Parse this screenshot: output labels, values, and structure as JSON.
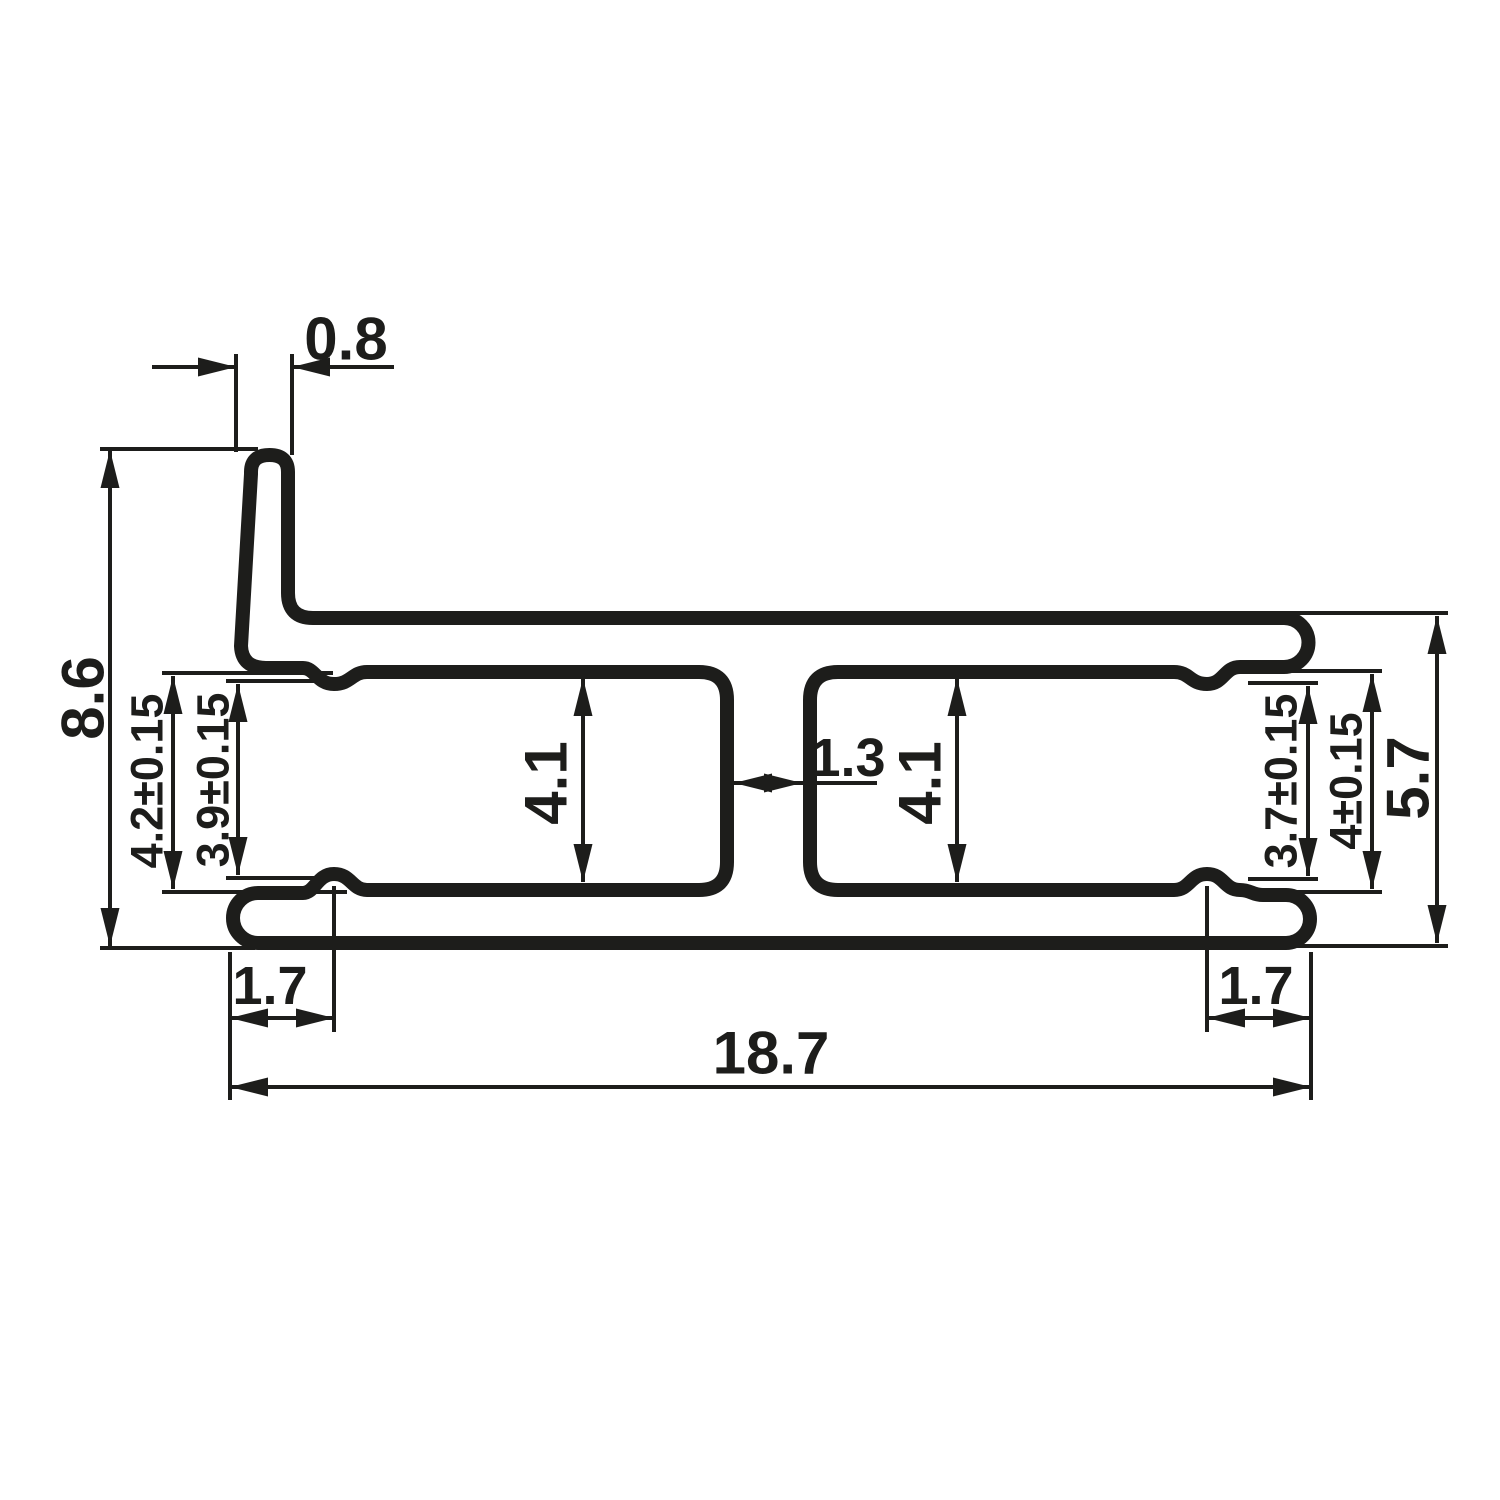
{
  "drawing": {
    "kind": "profile-cross-section",
    "ink_color": "#1d1d1b",
    "background_color": "#ffffff",
    "dimensions": [
      {
        "name": "lip-width",
        "label": "0.8",
        "orientation": "horizontal"
      },
      {
        "name": "overall-height-left",
        "label": "8.6",
        "orientation": "vertical"
      },
      {
        "name": "left-slot-opening",
        "label": "4.2±0.15",
        "orientation": "vertical"
      },
      {
        "name": "left-slot-between-nubs",
        "label": "3.9±0.15",
        "orientation": "vertical"
      },
      {
        "name": "left-slot-inner-height",
        "label": "4.1",
        "orientation": "vertical"
      },
      {
        "name": "center-web-thickness",
        "label": "1.3",
        "orientation": "horizontal"
      },
      {
        "name": "right-slot-inner-height",
        "label": "4.1",
        "orientation": "vertical"
      },
      {
        "name": "right-slot-between-nubs",
        "label": "3.7±0.15",
        "orientation": "vertical"
      },
      {
        "name": "right-slot-opening",
        "label": "4±0.15",
        "orientation": "vertical"
      },
      {
        "name": "right-overall-height",
        "label": "5.7",
        "orientation": "vertical"
      },
      {
        "name": "bottom-left-end-length",
        "label": "1.7",
        "orientation": "horizontal"
      },
      {
        "name": "bottom-right-end-length",
        "label": "1.7",
        "orientation": "horizontal"
      },
      {
        "name": "overall-width",
        "label": "18.7",
        "orientation": "horizontal"
      }
    ]
  }
}
